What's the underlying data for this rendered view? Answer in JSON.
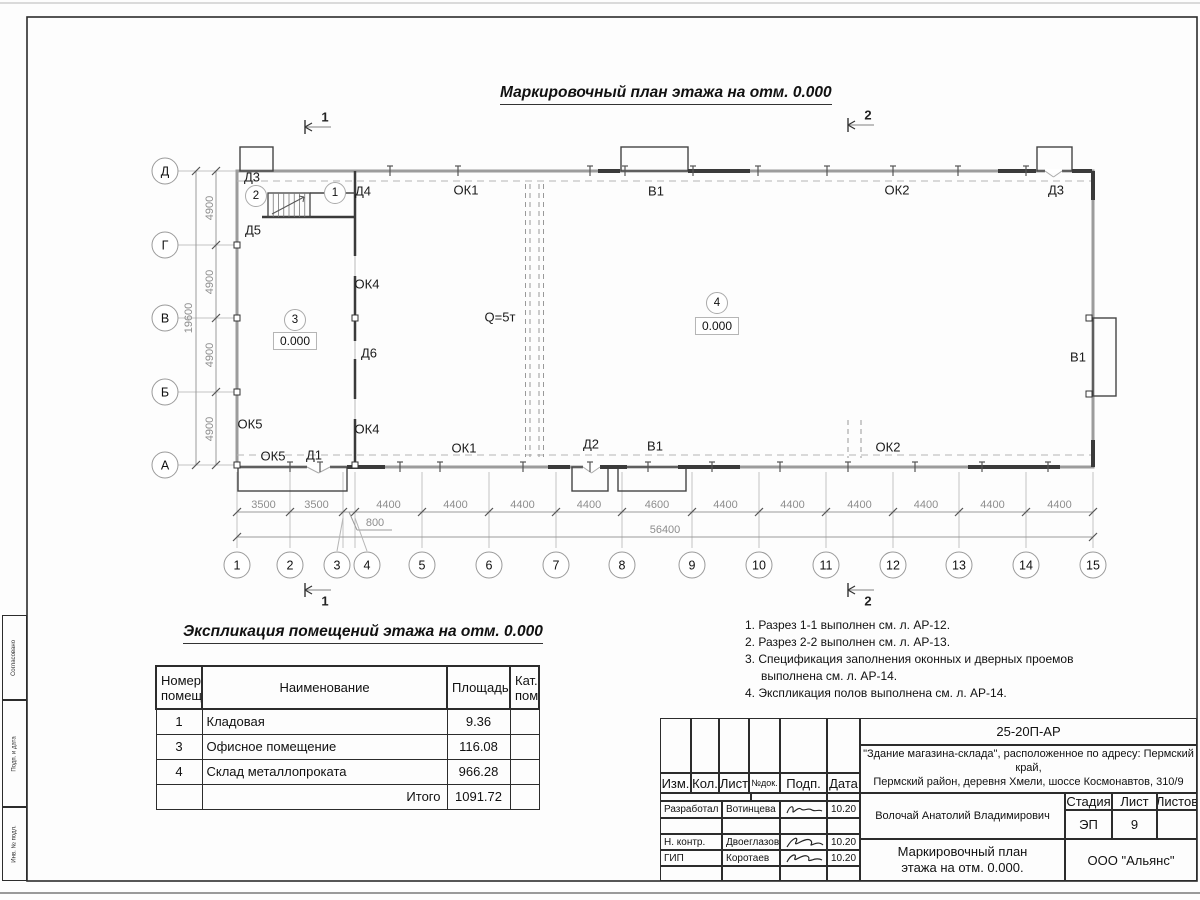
{
  "titles": {
    "plan": "Маркировочный план этажа на отм. 0.000",
    "explication": "Экспликация помещений этажа на отм. 0.000"
  },
  "plan": {
    "row_axes": [
      "Д",
      "Г",
      "В",
      "Б",
      "А"
    ],
    "col_axes": [
      "1",
      "2",
      "3",
      "4",
      "5",
      "6",
      "7",
      "8",
      "9",
      "10",
      "11",
      "12",
      "13",
      "14",
      "15"
    ],
    "v_dims": [
      "4900",
      "4900",
      "4900",
      "4900"
    ],
    "v_total": "19600",
    "h_dims": [
      "3500",
      "3500",
      "800",
      "4400",
      "4400",
      "4400",
      "4400",
      "4600",
      "4400",
      "4400",
      "4400",
      "4400",
      "4400",
      "4400"
    ],
    "h_total": "56400",
    "section_cuts": [
      "1",
      "2"
    ],
    "room_marks": [
      "1",
      "2",
      "3",
      "4"
    ],
    "elevation": "0.000",
    "crane_label": "Q=5т",
    "opening_labels": [
      "Д3",
      "Д4",
      "Д5",
      "ОК4",
      "Д6",
      "ОК4",
      "ОК5",
      "ОК5",
      "Д1",
      "ОК1",
      "В1",
      "ОК2",
      "Д3",
      "ОК1",
      "Д2",
      "В1",
      "ОК2",
      "В1"
    ]
  },
  "explication": {
    "headers": {
      "num": "Номер помещ.",
      "name": "Наименование",
      "area": "Площадь",
      "cat": "Кат. пом."
    },
    "rows": [
      {
        "num": "1",
        "name": "Кладовая",
        "area": "9.36",
        "cat": ""
      },
      {
        "num": "3",
        "name": "Офисное помещение",
        "area": "116.08",
        "cat": ""
      },
      {
        "num": "4",
        "name": "Склад металлопроката",
        "area": "966.28",
        "cat": ""
      }
    ],
    "total_label": "Итого",
    "total_value": "1091.72"
  },
  "notes": [
    "1. Разрез 1-1 выполнен см. л. АР-12.",
    "2. Разрез 2-2 выполнен см. л. АР-13.",
    "3. Спецификация заполнения оконных и дверных проемов выполнена см. л. АР-14.",
    "4. Экспликация полов выполнена см. л. АР-14."
  ],
  "title_block": {
    "doc_code": "25-20П-АР",
    "object_line1": "\"Здание магазина-склада\", расположенное по адресу: Пермский край,",
    "object_line2": "Пермский район, деревня Хмели, шоссе Космонавтов, 310/9",
    "cols": {
      "izm": "Изм.",
      "kol": "Кол.",
      "list": "Лист",
      "ndok": "№док.",
      "podp": "Подп.",
      "data": "Дата"
    },
    "roles": [
      {
        "role": "Разработал",
        "name": "Вотинцева",
        "date": "10.20"
      },
      {
        "role": "Н. контр.",
        "name": "Двоеглазов",
        "date": "10.20"
      },
      {
        "role": "ГИП",
        "name": "Коротаев",
        "date": "10.20"
      }
    ],
    "approver": "Волочай Анатолий Владимирович",
    "stage_label": "Стадия",
    "sheet_label": "Лист",
    "sheets_label": "Листов",
    "stage_value": "ЭП",
    "sheet_value": "9",
    "sheets_value": "",
    "doc_title_line1": "Маркировочный план",
    "doc_title_line2": "этажа на отм. 0.000.",
    "org": "ООО \"Альянс\""
  },
  "side_strip": {
    "cells": [
      "Согласовано",
      "Подп. и дата",
      "Инв. № подл."
    ]
  },
  "colors": {
    "wall_gray": "#9c9c9c",
    "wall_dark": "#3a3a3a",
    "dim_gray": "#8d8d8d",
    "axis_dash": "#b5b5b5",
    "frame": "#2c2c2c"
  }
}
